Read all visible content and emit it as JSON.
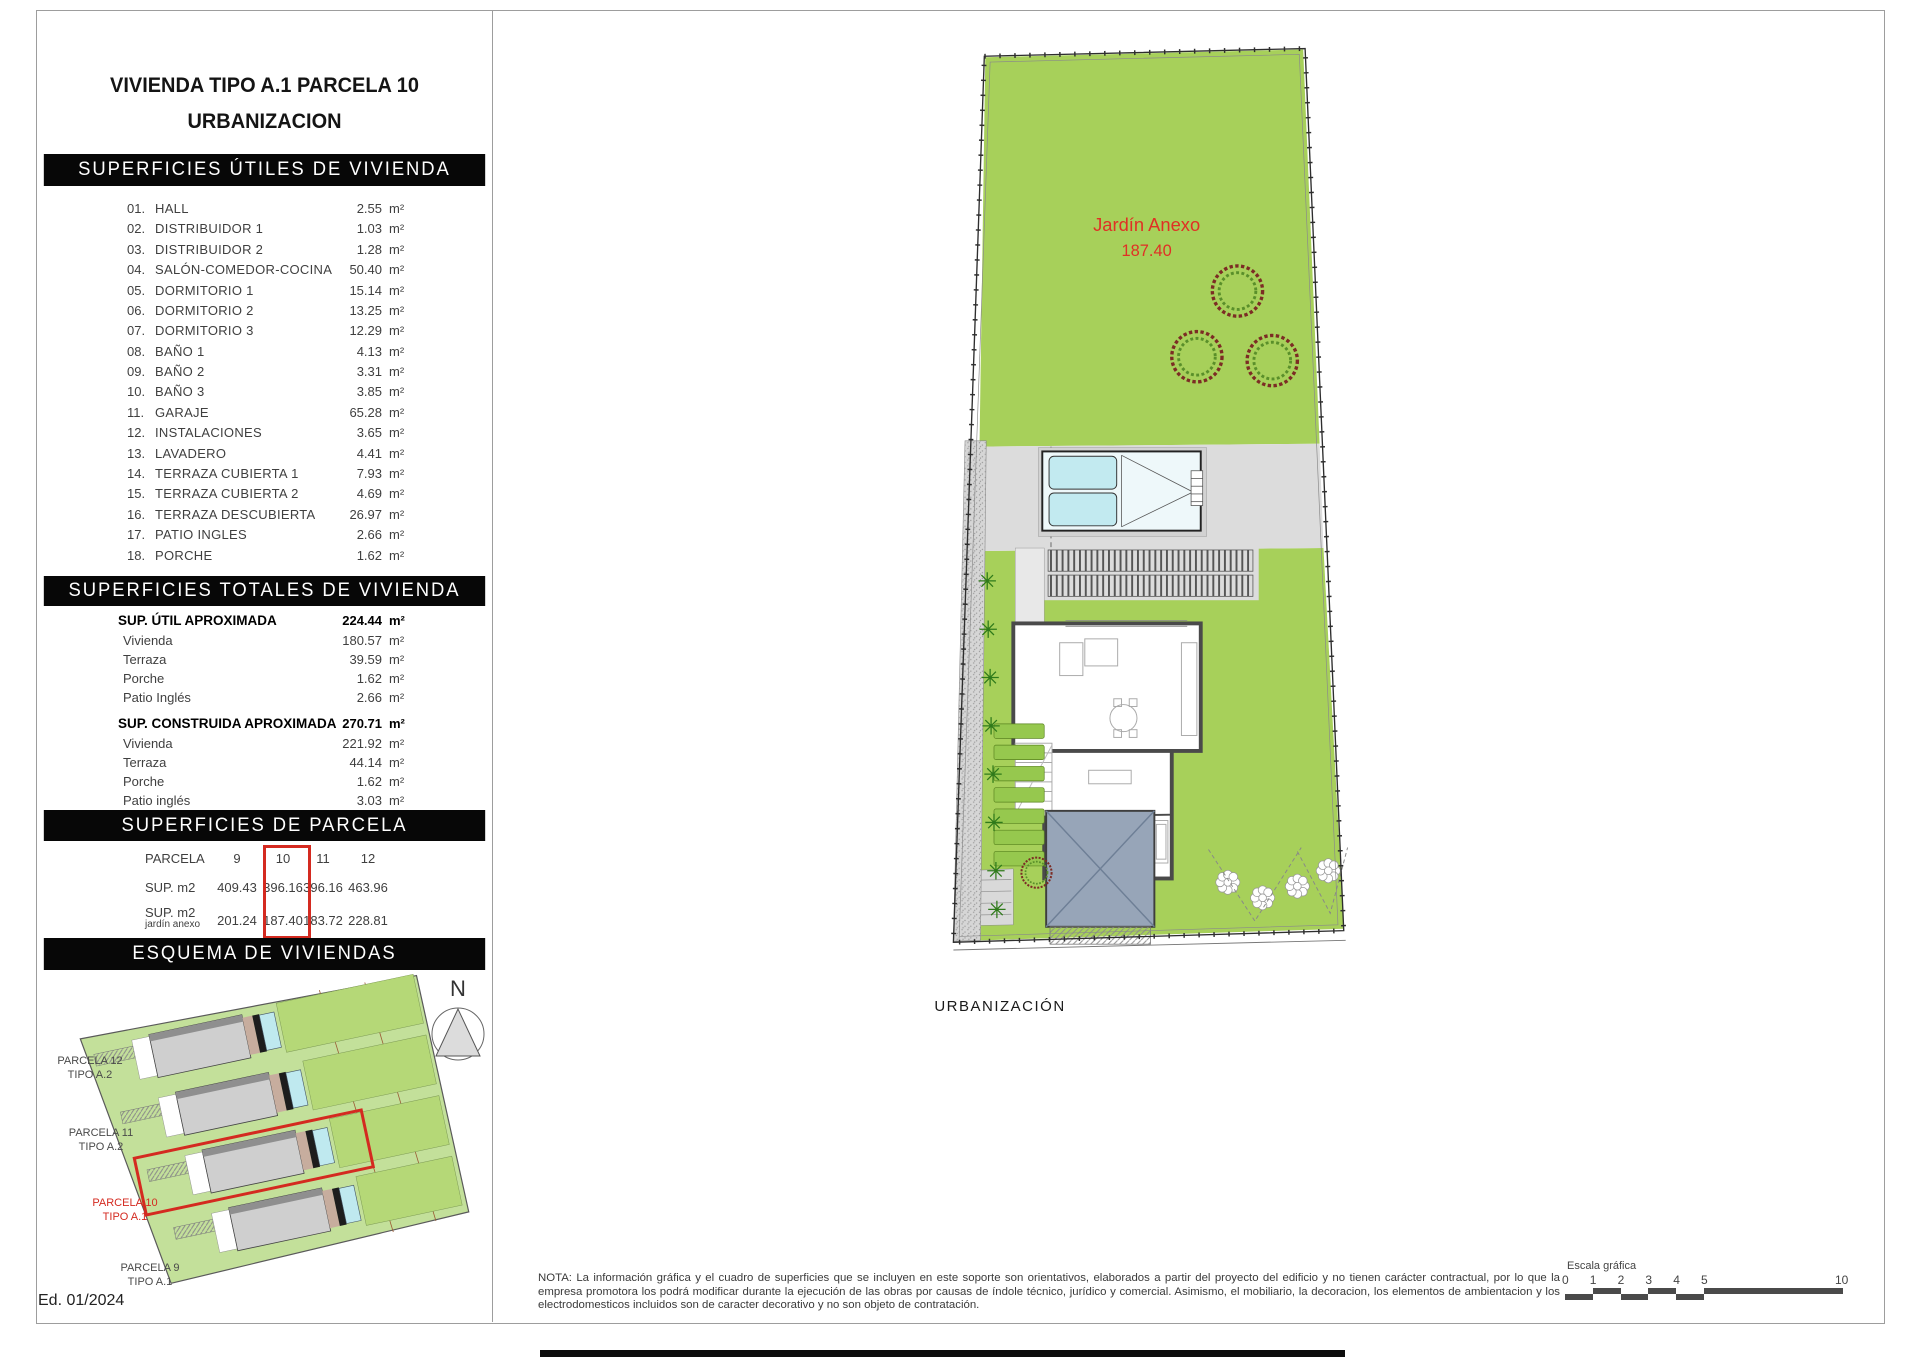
{
  "left_panel": {
    "title_line1": "VIVIENDA TIPO A.1 PARCELA 10",
    "title_line2": "URBANIZACION",
    "utiles": {
      "header": "SUPERFICIES ÚTILES DE VIVIENDA",
      "unit": "m²",
      "rows": [
        [
          "01.",
          "HALL",
          "2.55"
        ],
        [
          "02.",
          "DISTRIBUIDOR 1",
          "1.03"
        ],
        [
          "03.",
          "DISTRIBUIDOR 2",
          "1.28"
        ],
        [
          "04.",
          "SALÓN-COMEDOR-COCINA",
          "50.40"
        ],
        [
          "05.",
          "DORMITORIO 1",
          "15.14"
        ],
        [
          "06.",
          "DORMITORIO 2",
          "13.25"
        ],
        [
          "07.",
          "DORMITORIO 3",
          "12.29"
        ],
        [
          "08.",
          "BAÑO 1",
          "4.13"
        ],
        [
          "09.",
          "BAÑO 2",
          "3.31"
        ],
        [
          "10.",
          "BAÑO 3",
          "3.85"
        ],
        [
          "11.",
          "GARAJE",
          "65.28"
        ],
        [
          "12.",
          "INSTALACIONES",
          "3.65"
        ],
        [
          "13.",
          "LAVADERO",
          "4.41"
        ],
        [
          "14.",
          "TERRAZA CUBIERTA 1",
          "7.93"
        ],
        [
          "15.",
          "TERRAZA CUBIERTA 2",
          "4.69"
        ],
        [
          "16.",
          "TERRAZA DESCUBIERTA",
          "26.97"
        ],
        [
          "17.",
          "PATIO INGLES",
          "2.66"
        ],
        [
          "18.",
          "PORCHE",
          "1.62"
        ]
      ]
    },
    "totales": {
      "header": "SUPERFICIES TOTALES DE VIVIENDA",
      "unit": "m²",
      "groups": [
        {
          "title": "SUP. ÚTIL APROXIMADA",
          "value": "224.44",
          "rows": [
            [
              "Vivienda",
              "180.57"
            ],
            [
              "Terraza",
              "39.59"
            ],
            [
              "Porche",
              "1.62"
            ],
            [
              "Patio Inglés",
              "2.66"
            ]
          ]
        },
        {
          "title": "SUP. CONSTRUIDA APROXIMADA",
          "value": "270.71",
          "rows": [
            [
              "Vivienda",
              "221.92"
            ],
            [
              "Terraza",
              "44.14"
            ],
            [
              "Porche",
              "1.62"
            ],
            [
              "Patio inglés",
              "3.03"
            ]
          ]
        }
      ]
    },
    "parcela": {
      "header": "SUPERFICIES DE PARCELA",
      "row1_label": "PARCELA",
      "row2_label": "SUP. m2",
      "row3_label_line1": "SUP. m2",
      "row3_label_line2": "jardín anexo",
      "columns": [
        "9",
        "10",
        "11",
        "12"
      ],
      "sup_m2": [
        "409.43",
        "396.16",
        "396.16",
        "463.96"
      ],
      "sup_jardin": [
        "201.24",
        "187.40",
        "183.72",
        "228.81"
      ],
      "highlight_column": "10"
    },
    "esquema": {
      "header": "ESQUEMA DE VIVIENDAS",
      "labels": [
        {
          "l1": "PARCELA 12",
          "l2": "TIPO A.2"
        },
        {
          "l1": "PARCELA 11",
          "l2": "TIPO A.2"
        },
        {
          "l1": "PARCELA 10",
          "l2": "TIPO A.1"
        },
        {
          "l1": "PARCELA 9",
          "l2": "TIPO A.1"
        }
      ]
    },
    "edition": "Ed. 01/2024"
  },
  "plan": {
    "garden_label": "Jardín Anexo",
    "garden_area": "187.40",
    "bottom_label": "URBANIZACIÓN",
    "compass": "N"
  },
  "footer": {
    "note": "NOTA: La información gráfica y el cuadro de superficies que se incluyen en este soporte son orientativos, elaborados a partir del proyecto del edificio y no tienen carácter contractual, por lo que la empresa promotora los podrá modificar durante la ejecución de las obras por causas de índole técnico, jurídico y comercial. Asimismo, el mobiliario, la decoracion, los elementos de ambientacion y los electrodomesticos incluidos son de caracter decorativo y no son objeto de contratación.",
    "scale_label": "Escala gráfica",
    "scale_ticks": [
      "0",
      "1",
      "2",
      "3",
      "4",
      "5",
      "10"
    ]
  },
  "colors": {
    "accent_red": "#d42a20",
    "garden_green": "#a7d05a",
    "pool_cyan": "#c2eaf0",
    "garage_blue": "#97a5b8",
    "header_bar": "#070707"
  }
}
